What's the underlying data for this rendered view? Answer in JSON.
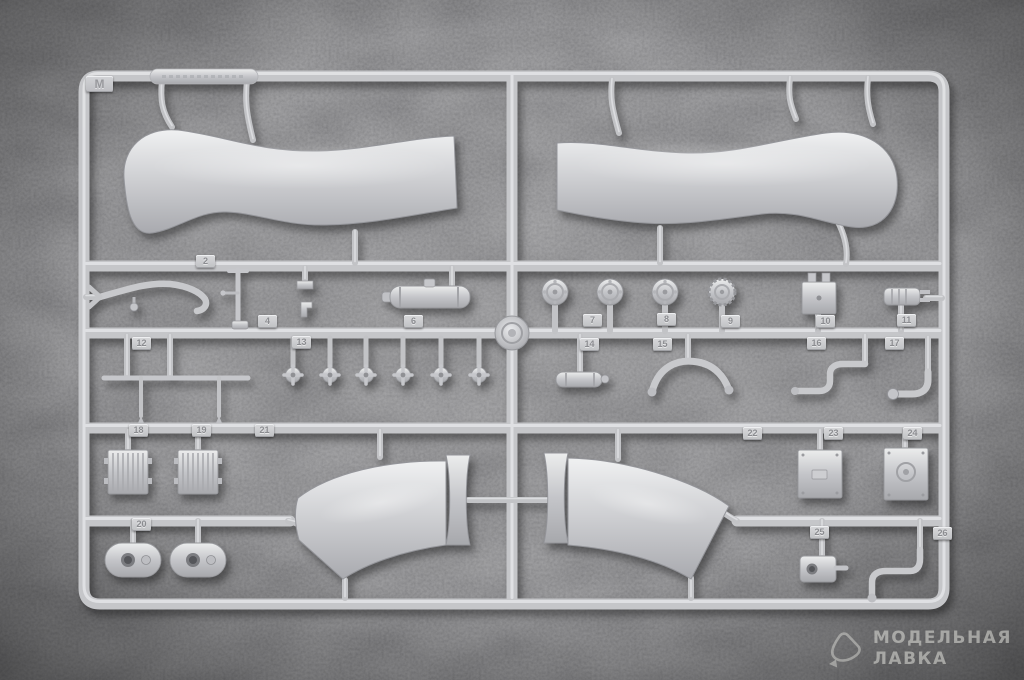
{
  "sprue": {
    "letter": "M",
    "tabs": [
      "M",
      "2",
      "4",
      "6",
      "7",
      "8",
      "9",
      "10",
      "11",
      "12",
      "13",
      "14",
      "15",
      "16",
      "17",
      "18",
      "19",
      "21",
      "22",
      "23",
      "24",
      "20",
      "25",
      "26"
    ]
  },
  "watermark": {
    "line1": "МОДЕЛЬНАЯ",
    "line2": "ЛАВКА"
  },
  "colors": {
    "background": "#525255",
    "plastic": "#c6c7ca",
    "plastic_highlight": "#e9eaec",
    "plastic_shadow": "#7a7b7e",
    "watermark_text": "#d6d6d0"
  }
}
